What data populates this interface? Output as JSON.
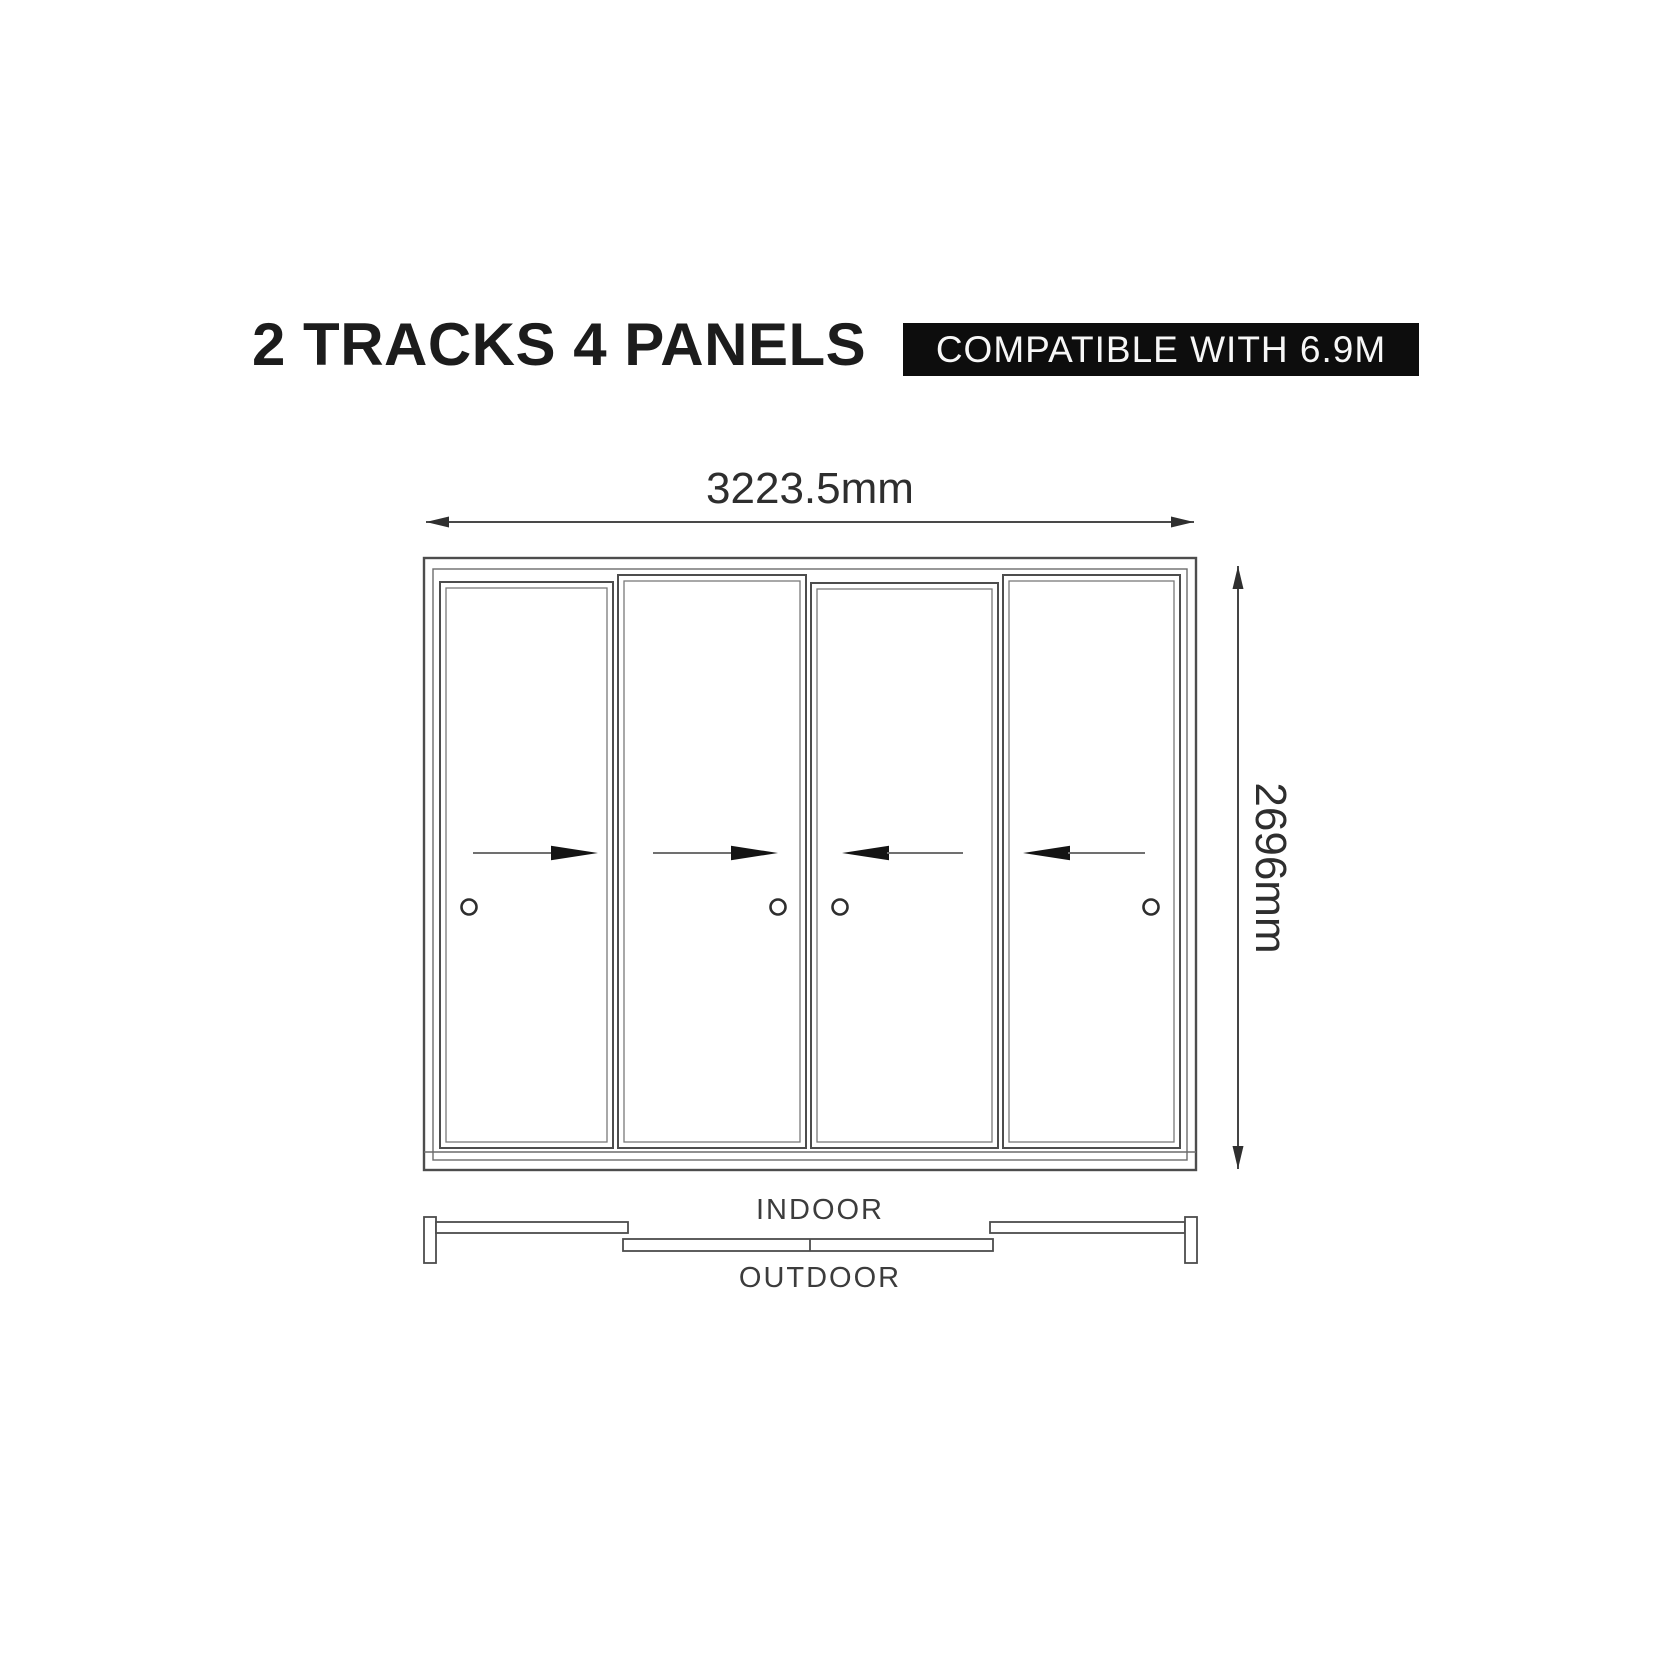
{
  "header": {
    "title": "2 TRACKS 4 PANELS",
    "badge": "COMPATIBLE WITH 6.9M"
  },
  "colors": {
    "background": "#ffffff",
    "title_text": "#1c1c1c",
    "badge_bg": "#0d0d0d",
    "badge_text": "#f7f7f7",
    "line": "#4d4d4d",
    "dimension": "#2e2e2e",
    "arrow_head": "#141414"
  },
  "diagram": {
    "type": "sliding-door-elevation",
    "tracks": 2,
    "panel_count": 4,
    "width_label": "3223.5mm",
    "height_label": "2696mm",
    "indoor_label": "INDOOR",
    "outdoor_label": "OUTDOOR",
    "panels": [
      {
        "id": 1,
        "slide_direction": "right",
        "handle_side": "left",
        "track": "indoor"
      },
      {
        "id": 2,
        "slide_direction": "right",
        "handle_side": "right",
        "track": "outdoor"
      },
      {
        "id": 3,
        "slide_direction": "left",
        "handle_side": "left",
        "track": "outdoor"
      },
      {
        "id": 4,
        "slide_direction": "left",
        "handle_side": "right",
        "track": "indoor"
      }
    ]
  }
}
